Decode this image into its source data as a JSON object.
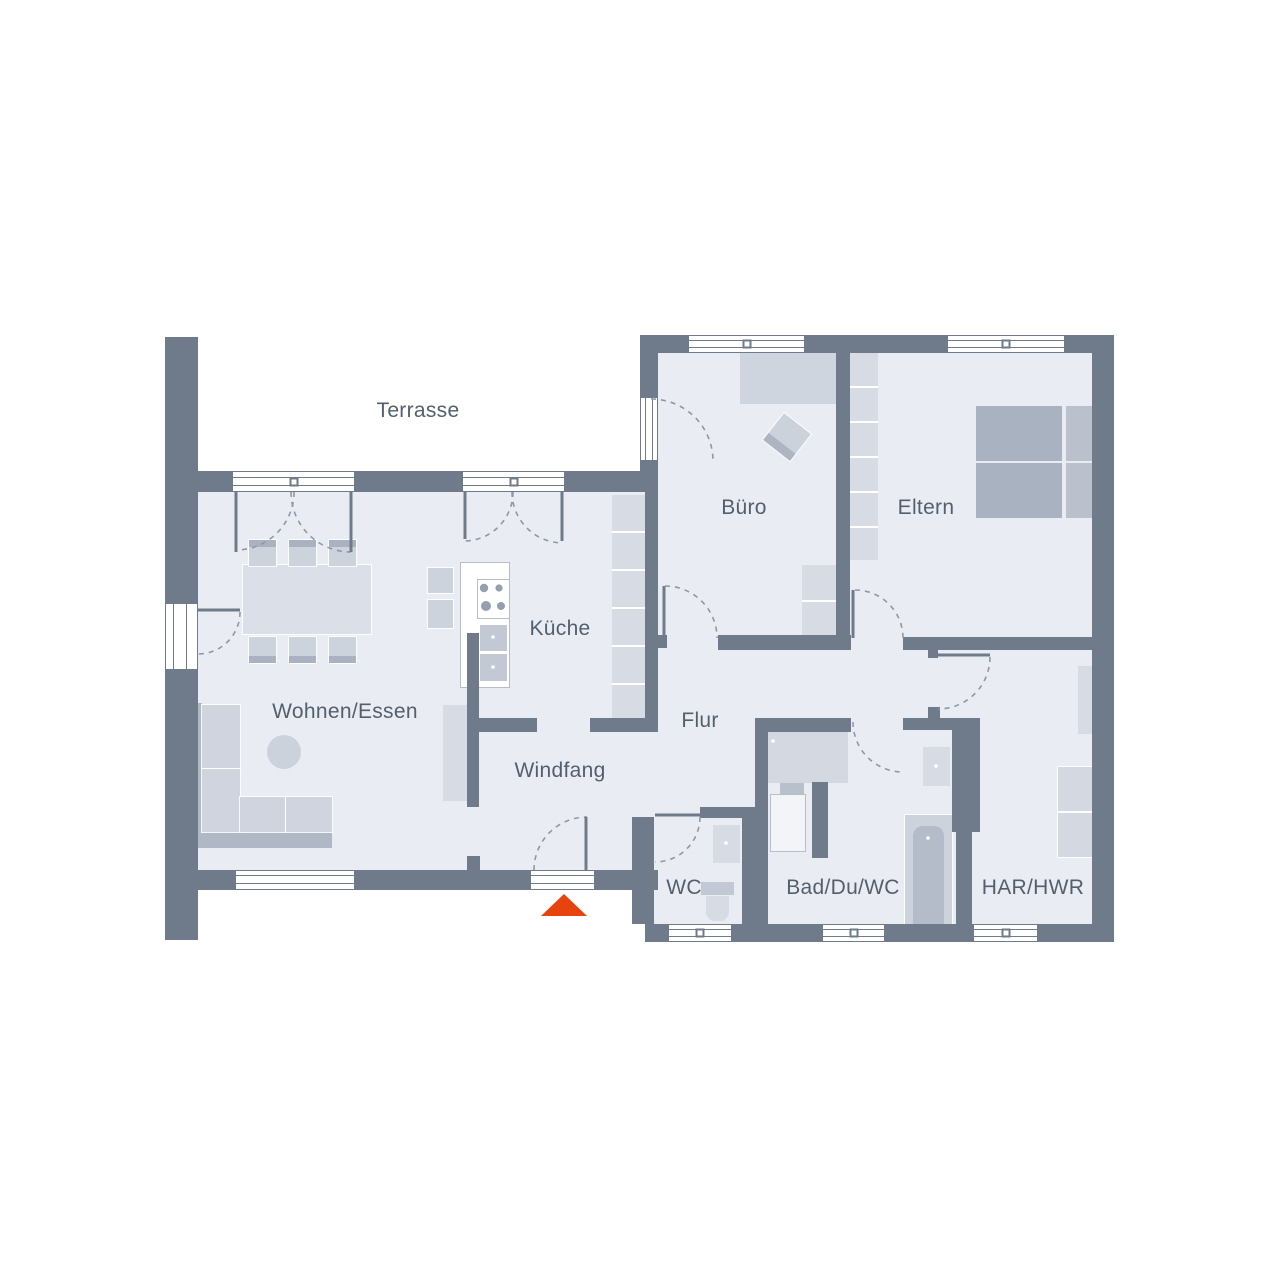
{
  "plan": {
    "title": "Grundriss",
    "type": "floor-plan",
    "rooms": [
      {
        "id": "terrasse",
        "label": "Terrasse",
        "x": 418,
        "y": 411
      },
      {
        "id": "buero",
        "label": "Büro",
        "x": 744,
        "y": 508
      },
      {
        "id": "eltern",
        "label": "Eltern",
        "x": 926,
        "y": 508
      },
      {
        "id": "kueche",
        "label": "Küche",
        "x": 560,
        "y": 629
      },
      {
        "id": "wohnen-essen",
        "label": "Wohnen/Essen",
        "x": 345,
        "y": 712
      },
      {
        "id": "flur",
        "label": "Flur",
        "x": 700,
        "y": 721
      },
      {
        "id": "windfang",
        "label": "Windfang",
        "x": 560,
        "y": 771
      },
      {
        "id": "wc",
        "label": "WC",
        "x": 684,
        "y": 888
      },
      {
        "id": "bad-du-wc",
        "label": "Bad/Du/WC",
        "x": 843,
        "y": 888
      },
      {
        "id": "har-hwr",
        "label": "HAR/HWR",
        "x": 1033,
        "y": 888
      }
    ],
    "colors": {
      "wall": "#6f7b8a",
      "floor": "#e9edf3",
      "furniture_light": "#d6dbe4",
      "furniture_medium": "#cdd3dd",
      "furniture_dark": "#aab2c1",
      "entrance_marker": "#e8430f",
      "label_text": "#545f6e",
      "door_arc": "#8e98a6"
    },
    "entrance_marker": {
      "shape": "triangle",
      "meaning": "entrance"
    }
  }
}
